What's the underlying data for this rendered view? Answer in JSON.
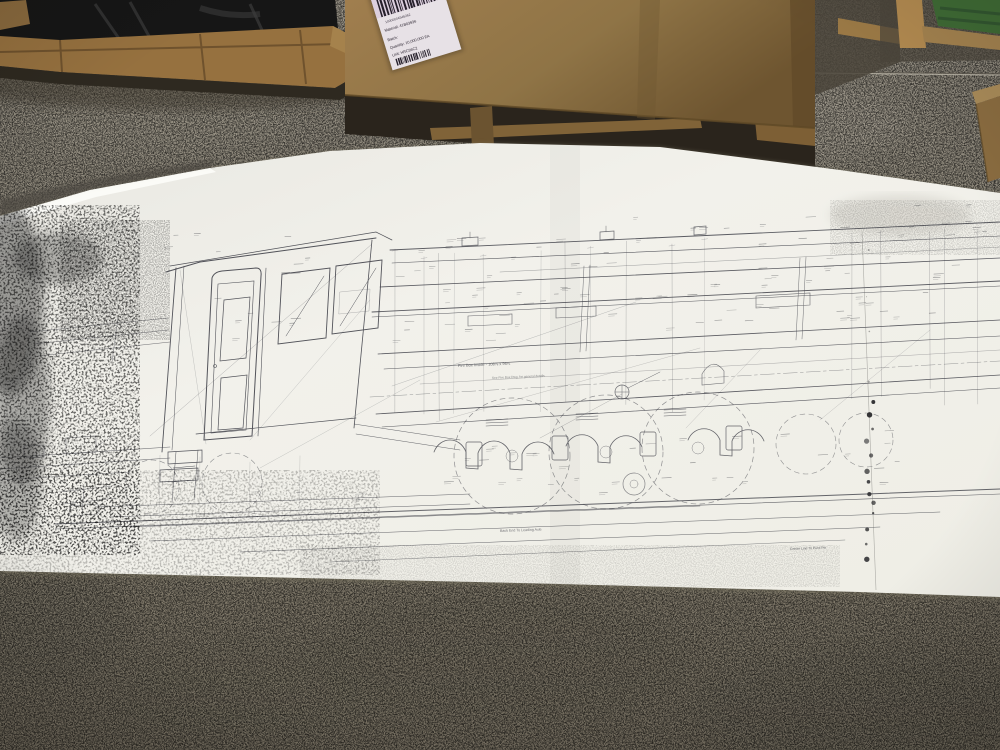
{
  "shipping_label": {
    "barcode_digits": "10000004546262",
    "lines": [
      "Material:   41B03936",
      "Batch:",
      "Quantity:      10,000.000   EA",
      "Unit:  HRC96C2"
    ]
  },
  "blueprint_annotations": {
    "firebox_note": "Fire Box Inside - 108⅞ x 96¼",
    "firebox_subnote": "See Fire Box Dwg. for general details",
    "bottom_note": "Back End To Leading Axle",
    "pivot_note": "Centre Line To Pivot Pin"
  },
  "colors": {
    "paper": "#f0efe9",
    "drawing_line": "#41424a",
    "floor": "#8f897b",
    "cardboard": "#8f7446",
    "pallet_wood": "#96713f",
    "shrink_wrap": "#161616",
    "green_crate": "#3f6b35",
    "label_tint": "#e7e1e6",
    "concrete_seam": "#5c574e"
  }
}
